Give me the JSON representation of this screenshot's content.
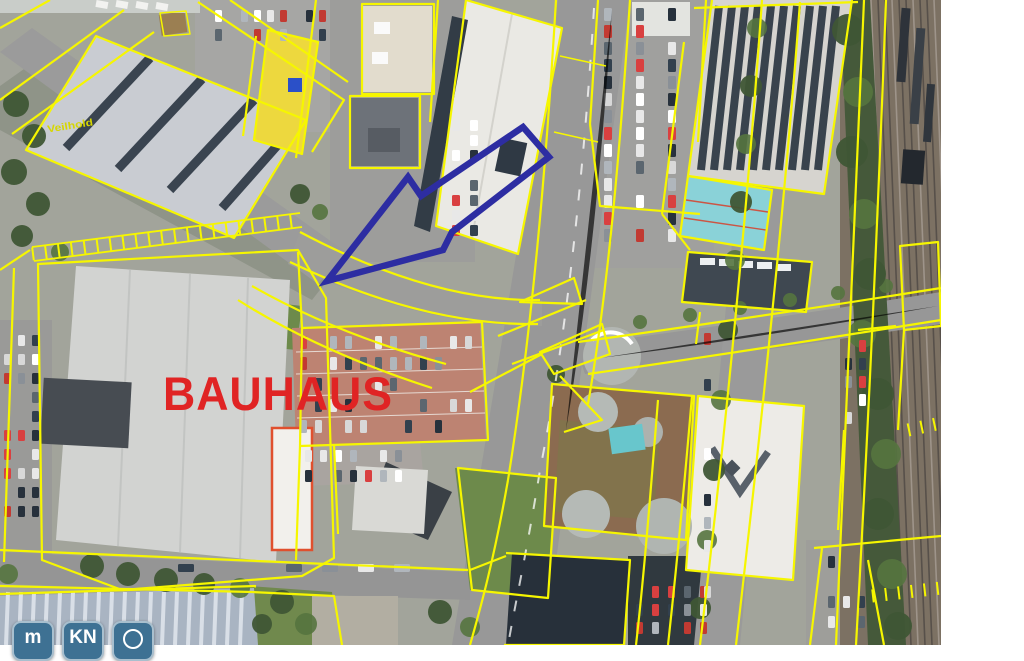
{
  "map": {
    "labels": {
      "store": "BAUHAUS",
      "area": "Veilhold"
    },
    "colors": {
      "parcel_line": "#f6f600",
      "arrow": "#2d2da2",
      "store_label": "#e02424",
      "area_label": "#d6d600",
      "button_bg": "#3e7193",
      "button_fg": "#ffffff"
    }
  },
  "controls": {
    "buttons": [
      {
        "id": "measure",
        "label": "m"
      },
      {
        "id": "kn",
        "label": "KN"
      },
      {
        "id": "circle",
        "label": ""
      }
    ]
  }
}
